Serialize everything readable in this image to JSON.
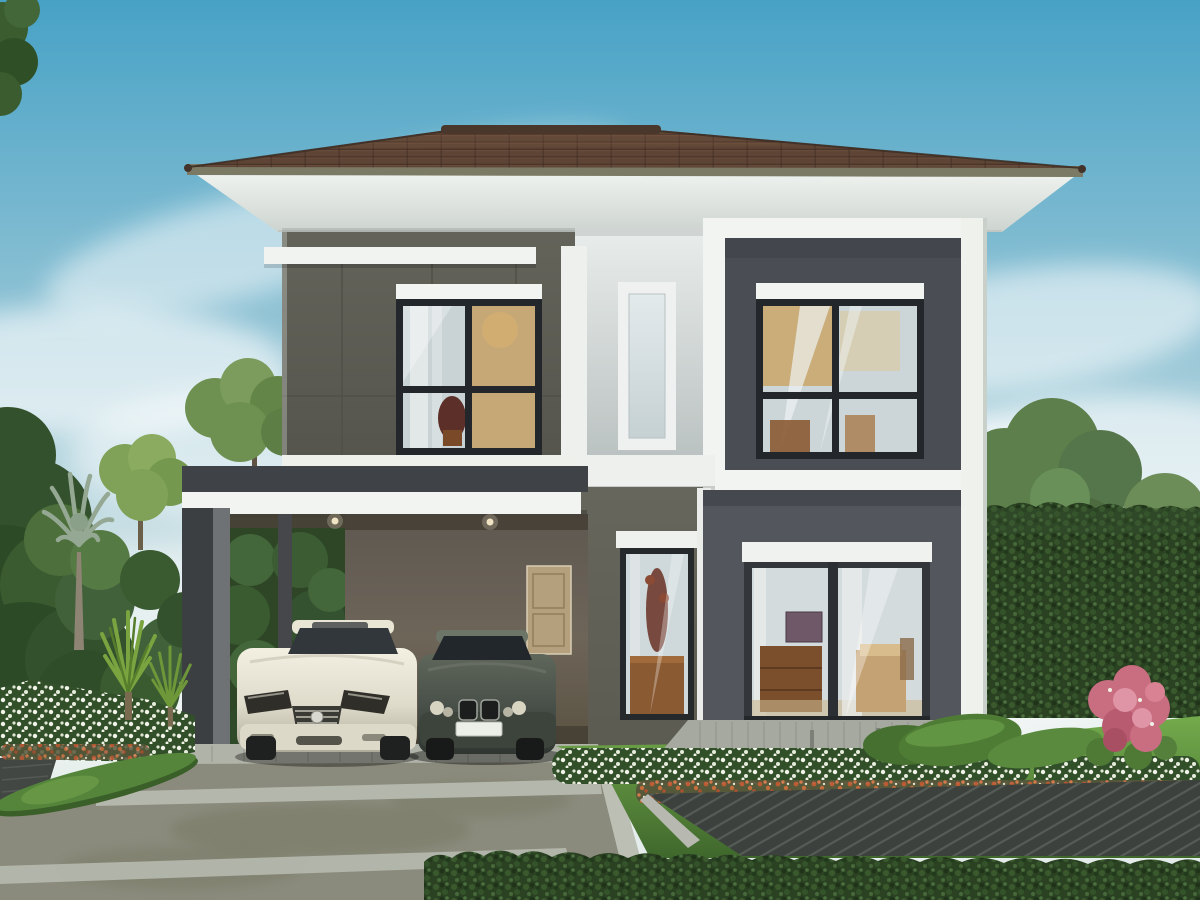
{
  "meta": {
    "type": "architectural-rendering",
    "subject": "Modern two-storey house exterior with double carport, two parked sedans and landscaped garden",
    "canvas": {
      "width": 1200,
      "height": 900
    }
  },
  "scene": {
    "sky": "daytime blue sky, soft white clouds, paler toward horizon",
    "house": {
      "storeys": 2,
      "roof": {
        "type": "hipped",
        "material": "brown concrete tiles",
        "fascia": "olive strip",
        "soffit": "wide white eave"
      },
      "upper_floor": {
        "left": "olive-grey panel wall, white ledge bar, black-framed 4-pane window with white roller-shade box",
        "centre": "light grey rendered wall with tall narrow frosted slit window in white frame",
        "right": "white-framed projecting box, dark slate infill, black-framed 4-pane window with white roller-shade box"
      },
      "ground_floor": {
        "left": "open double carport, flat roof slab with white fascia, recessed ceiling lights, tan rear door, grey columns",
        "centre": "olive wall with tall narrow display window",
        "right": "dark slate wall with two-panel sliding glass door opening to a grey paver terrace"
      }
    },
    "vehicles": [
      {
        "name": "cream sedan",
        "position": "left carport bay",
        "facing": "viewer"
      },
      {
        "name": "dark grey-green sedan",
        "position": "right carport bay",
        "facing": "viewer"
      }
    ],
    "landscape": {
      "left": [
        "palm tree",
        "dense dark shrub wall",
        "light green trees",
        "spiky dracaena plants",
        "white flower bed with orange accents",
        "low clipped hedge roll along driveway",
        "small dark timber deck corner"
      ],
      "right": [
        "large deciduous tree",
        "tall clipped hedge wall",
        "pale distant treeline",
        "pink flowering shrub",
        "white and orange-red flower borders",
        "low hedge roll",
        "lawn"
      ],
      "foreground": [
        "concrete driveway with light paver bands",
        "paver apron under carport",
        "dark timber deck with diagonal boards",
        "long trimmed hedge along bottom edge",
        "grey paver terrace with small light bollards"
      ]
    },
    "palette": {
      "sky_top": "#47a2c6",
      "sky_mid": "#8fc2d4",
      "sky_horizon": "#eaf1ef",
      "cloud": "#ffffff",
      "roof_tile": "#5d4434",
      "roof_ridge": "#4a372c",
      "roof_fascia": "#7b7a64",
      "soffit": "#eef1ee",
      "wall_olive": "#63635a",
      "wall_olive_ground": "#67665c",
      "wall_light": "#dce3e2",
      "wall_dark_panel": "#4a4e54",
      "wall_dark_ground": "#53565c",
      "trim_white": "#f2f4f1",
      "window_frame": "#23262a",
      "glass_cool": "#ccd6d9",
      "glass_warm": "#c9a35f",
      "carport_wall": "#6e6358",
      "column_dark": "#3c3f42",
      "door_tan": "#b5a07d",
      "car_cream": "#e9e6d6",
      "car_dark": "#49514a",
      "driveway": "#8b8b7d",
      "paver_light": "#b6b9ae",
      "grass_light": "#74ab4c",
      "grass_dark": "#3f672c",
      "hedge": "#2a4122",
      "hedge_mound": "#4f7c35",
      "tree_dark": "#33512c",
      "tree_mid": "#5d7f4b",
      "tree_light": "#7fa258",
      "tree_pale": "#9db98c",
      "palm": "#95a893",
      "flower_white": "#eef1e6",
      "flower_red": "#c05a35",
      "flower_pink": "#c96d80",
      "deck": "#3c413e",
      "terrace": "#a6a9a0"
    }
  }
}
